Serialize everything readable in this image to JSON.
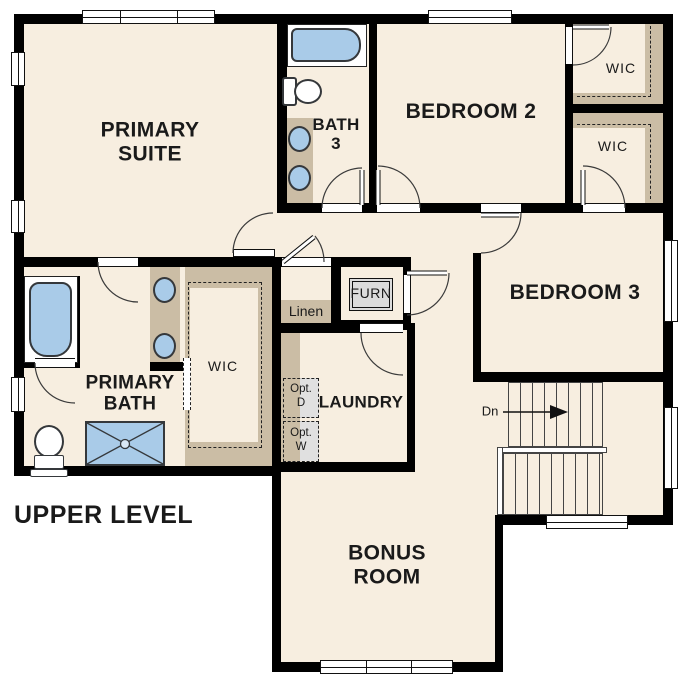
{
  "title": "UPPER LEVEL",
  "rooms": {
    "primary_suite": {
      "line1": "PRIMARY",
      "line2": "SUITE"
    },
    "bath3": {
      "line1": "BATH",
      "line2": "3"
    },
    "bedroom2": {
      "label": "BEDROOM 2"
    },
    "bedroom3": {
      "label": "BEDROOM 3"
    },
    "wic_bedroom2": {
      "label": "WIC"
    },
    "wic_bedroom3": {
      "label": "WIC"
    },
    "wic_primary": {
      "label": "WIC"
    },
    "primary_bath": {
      "line1": "PRIMARY",
      "line2": "BATH"
    },
    "laundry": {
      "label": "LAUNDRY"
    },
    "bonus_room": {
      "line1": "BONUS",
      "line2": "ROOM"
    },
    "linen": {
      "label": "Linen"
    },
    "furnace": {
      "label": "FURN"
    }
  },
  "annotations": {
    "opt_dryer": {
      "line1": "Opt.",
      "line2": "D"
    },
    "opt_washer": {
      "line1": "Opt.",
      "line2": "W"
    },
    "stairs_down": {
      "label": "Dn"
    }
  },
  "colors": {
    "wall": "#000000",
    "floor": "#f7eee0",
    "tan": "#cbbda5",
    "blue": "#a9cbe8",
    "gray": "#dcdcdc",
    "ink": "#1a1a1a",
    "bg": "#ffffff"
  }
}
